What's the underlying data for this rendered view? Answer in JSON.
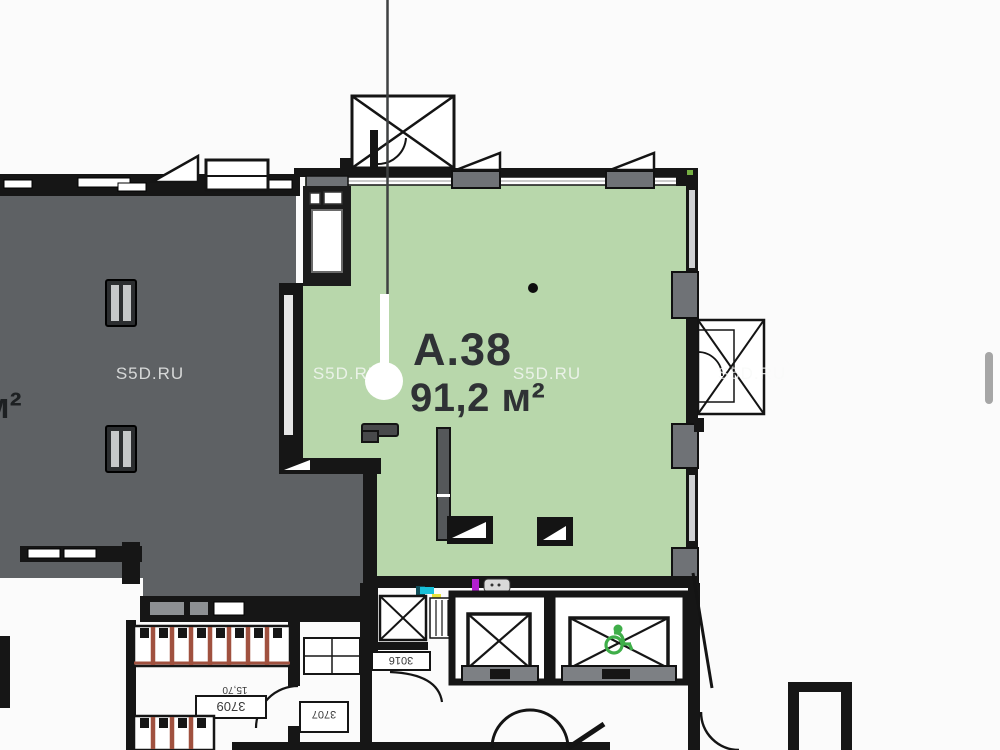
{
  "page": {
    "background": "#fbfbfb",
    "type_hint": "floor-plan-viewer"
  },
  "watermarks": [
    {
      "text": "S5D.RU"
    },
    {
      "text": "S5D.RU"
    },
    {
      "text": "S5D.RU"
    },
    {
      "text": "S5D.RU"
    }
  ],
  "selected_unit": {
    "id": "А.38",
    "area": "91,2 м²",
    "fill_color": "#b8d7ab"
  },
  "neighbor_unit": {
    "partial_area_label": "м²",
    "fill_color": "#5e6164"
  },
  "dimension_labels": {
    "stair_flight": "3709",
    "stair_area": "15,70",
    "shaft": "3016",
    "side_room": "3707"
  },
  "colors": {
    "walls": "#161616",
    "stair_steps": "#a0513f",
    "accessible_icon": "#3fae49",
    "scrollbar_thumb": "#a6a6a6",
    "pin": "#ffffff"
  }
}
